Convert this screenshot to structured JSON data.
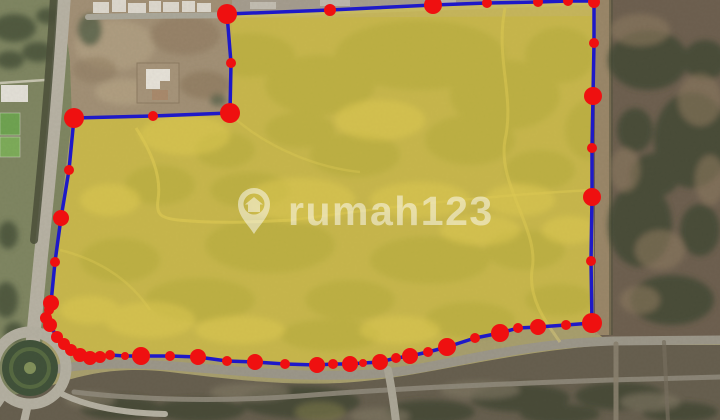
{
  "watermark": {
    "brand": "rumah123",
    "logo": "map-pin-house-icon",
    "color": "#ffffff",
    "opacity": 0.5
  },
  "map": {
    "image_type": "satellite",
    "plot_overlay": {
      "fill": "#e3cc2e",
      "fill_opacity": 0.52,
      "stroke": "#1e19c8",
      "stroke_width": 3.5,
      "points": [
        [
          227,
          14
        ],
        [
          330,
          10
        ],
        [
          433,
          5
        ],
        [
          487,
          3
        ],
        [
          538,
          2
        ],
        [
          568,
          1
        ],
        [
          594,
          1
        ],
        [
          594,
          43
        ],
        [
          593,
          96
        ],
        [
          592,
          148
        ],
        [
          592,
          197
        ],
        [
          591,
          261
        ],
        [
          592,
          323
        ],
        [
          566,
          325
        ],
        [
          538,
          327
        ],
        [
          518,
          328
        ],
        [
          500,
          333
        ],
        [
          475,
          338
        ],
        [
          447,
          347
        ],
        [
          428,
          352
        ],
        [
          410,
          356
        ],
        [
          396,
          358
        ],
        [
          380,
          362
        ],
        [
          363,
          363
        ],
        [
          350,
          364
        ],
        [
          333,
          364
        ],
        [
          317,
          365
        ],
        [
          285,
          364
        ],
        [
          255,
          362
        ],
        [
          227,
          361
        ],
        [
          198,
          357
        ],
        [
          170,
          356
        ],
        [
          141,
          356
        ],
        [
          125,
          356
        ],
        [
          110,
          355
        ],
        [
          100,
          357
        ],
        [
          90,
          358
        ],
        [
          80,
          355
        ],
        [
          71,
          350
        ],
        [
          64,
          344
        ],
        [
          57,
          337
        ],
        [
          50,
          325
        ],
        [
          46,
          318
        ],
        [
          49,
          310
        ],
        [
          51,
          303
        ],
        [
          55,
          262
        ],
        [
          61,
          218
        ],
        [
          69,
          170
        ],
        [
          74,
          118
        ],
        [
          153,
          116
        ],
        [
          230,
          113
        ],
        [
          231,
          63
        ]
      ]
    },
    "vertex_markers": {
      "color": "#ef1010",
      "dots": [
        [
          227,
          14,
          10
        ],
        [
          330,
          10,
          6
        ],
        [
          433,
          5,
          9
        ],
        [
          487,
          3,
          5
        ],
        [
          538,
          2,
          5
        ],
        [
          568,
          1,
          5
        ],
        [
          594,
          2,
          6
        ],
        [
          594,
          43,
          5
        ],
        [
          593,
          96,
          9
        ],
        [
          592,
          148,
          5
        ],
        [
          592,
          197,
          9
        ],
        [
          591,
          261,
          5
        ],
        [
          592,
          323,
          10
        ],
        [
          566,
          325,
          5
        ],
        [
          538,
          327,
          8
        ],
        [
          518,
          328,
          5
        ],
        [
          500,
          333,
          9
        ],
        [
          475,
          338,
          5
        ],
        [
          447,
          347,
          9
        ],
        [
          428,
          352,
          5
        ],
        [
          410,
          356,
          8
        ],
        [
          396,
          358,
          5
        ],
        [
          380,
          362,
          8
        ],
        [
          363,
          363,
          4
        ],
        [
          350,
          364,
          8
        ],
        [
          333,
          364,
          5
        ],
        [
          317,
          365,
          8
        ],
        [
          285,
          364,
          5
        ],
        [
          255,
          362,
          8
        ],
        [
          227,
          361,
          5
        ],
        [
          198,
          357,
          8
        ],
        [
          170,
          356,
          5
        ],
        [
          141,
          356,
          9
        ],
        [
          125,
          356,
          4
        ],
        [
          110,
          355,
          5
        ],
        [
          100,
          357,
          6
        ],
        [
          90,
          358,
          7
        ],
        [
          80,
          355,
          7
        ],
        [
          71,
          350,
          6
        ],
        [
          64,
          344,
          6
        ],
        [
          57,
          337,
          6
        ],
        [
          50,
          325,
          7
        ],
        [
          46,
          318,
          6
        ],
        [
          49,
          310,
          5
        ],
        [
          51,
          303,
          8
        ],
        [
          55,
          262,
          5
        ],
        [
          61,
          218,
          8
        ],
        [
          69,
          170,
          5
        ],
        [
          74,
          118,
          10
        ],
        [
          153,
          116,
          5
        ],
        [
          230,
          113,
          10
        ],
        [
          231,
          63,
          5
        ]
      ]
    },
    "palette": {
      "terrain_base": "#a89f6e",
      "field_dark_patch": "#7a8148",
      "field_light_patch": "#dcca7a",
      "left_zone": "#7f8662",
      "notch_dirt": "#a29076",
      "right_zone": "#6e6050",
      "bottom_zone": "#675f4f",
      "road": "#9c978a",
      "roundabout_island": "#41523a"
    }
  }
}
